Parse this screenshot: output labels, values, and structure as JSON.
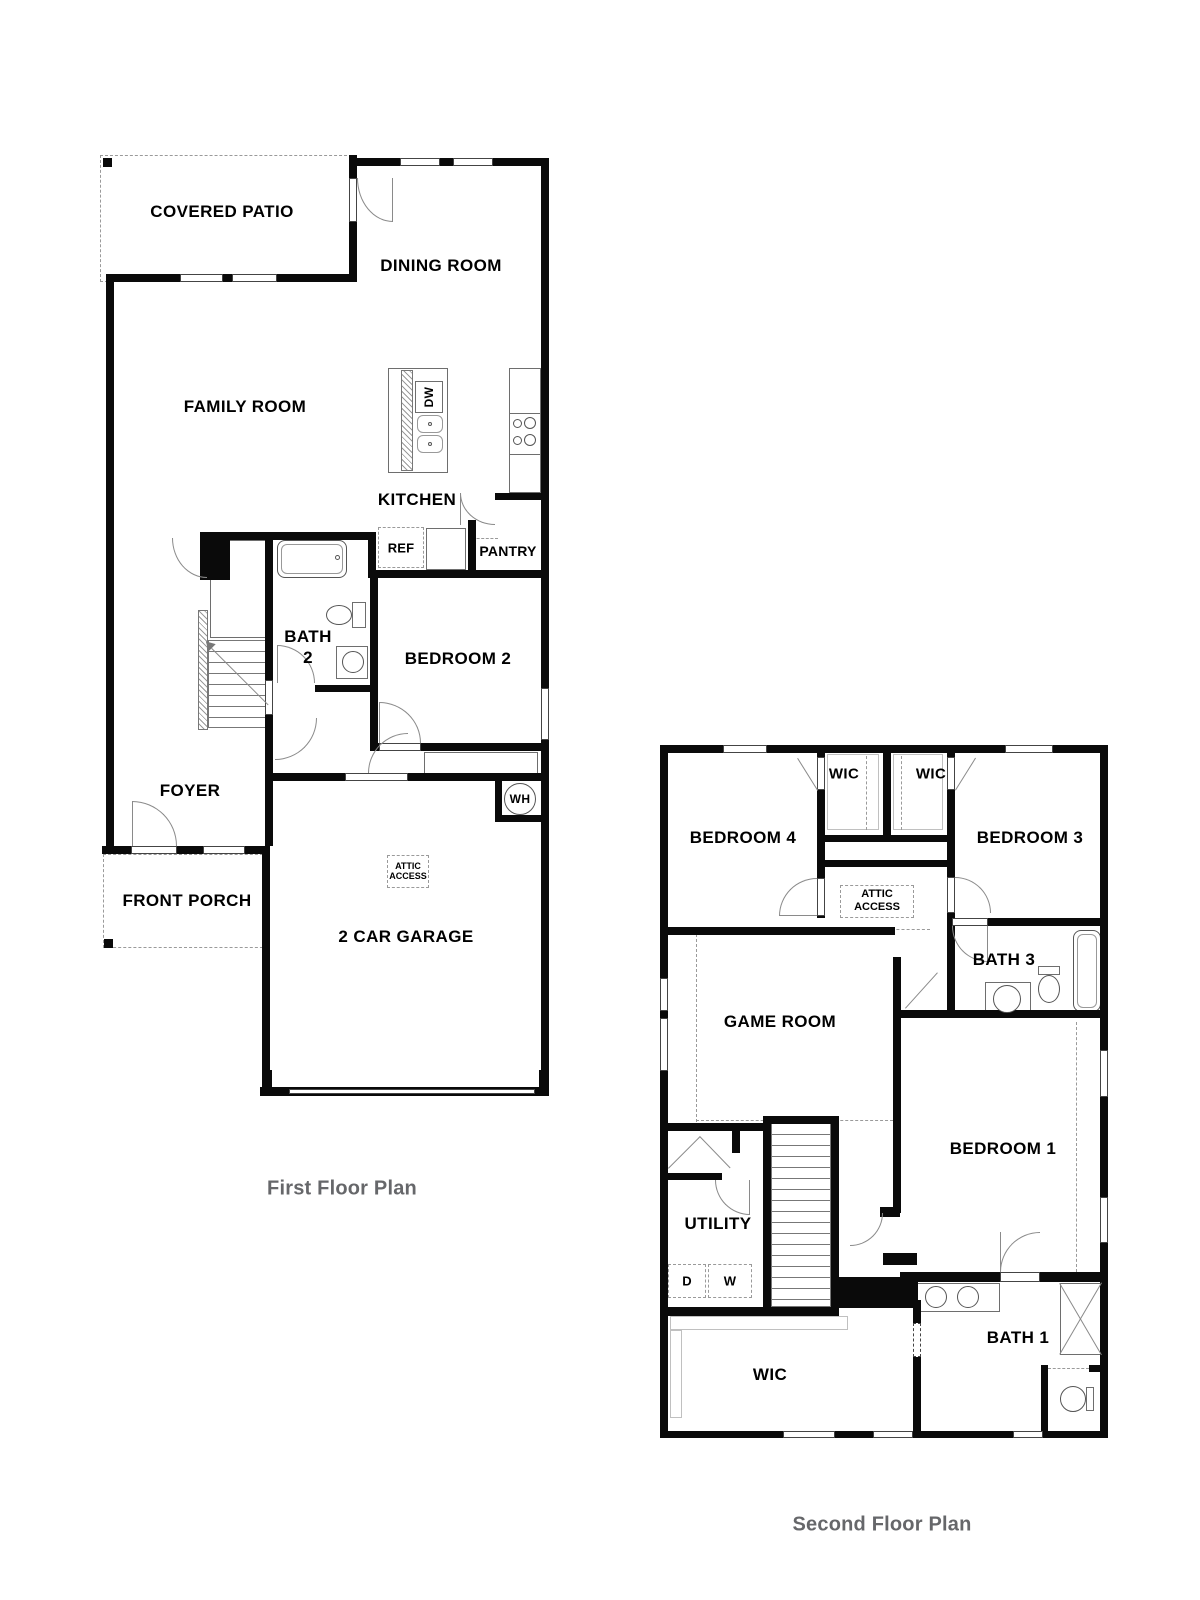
{
  "first_floor": {
    "title": "First Floor Plan",
    "rooms": {
      "covered_patio": "COVERED PATIO",
      "dining_room": "DINING ROOM",
      "family_room": "FAMILY ROOM",
      "kitchen": "KITCHEN",
      "pantry": "PANTRY",
      "bath_2_line1": "BATH",
      "bath_2_line2": "2",
      "bedroom_2": "BEDROOM 2",
      "foyer": "FOYER",
      "front_porch": "FRONT PORCH",
      "garage": "2 CAR GARAGE"
    },
    "fixtures": {
      "dishwasher": "DW",
      "refrigerator": "REF",
      "water_heater": "WH",
      "attic_access_line1": "ATTIC",
      "attic_access_line2": "ACCESS"
    }
  },
  "second_floor": {
    "title": "Second Floor Plan",
    "rooms": {
      "bedroom_4": "BEDROOM 4",
      "wic_left": "WIC",
      "wic_right": "WIC",
      "bedroom_3": "BEDROOM 3",
      "bath_3": "BATH 3",
      "game_room": "GAME ROOM",
      "bedroom_1": "BEDROOM 1",
      "utility": "UTILITY",
      "bath_1": "BATH 1",
      "wic_main": "WIC"
    },
    "fixtures": {
      "attic_access_line1": "ATTIC",
      "attic_access_line2": "ACCESS",
      "dryer": "D",
      "washer": "W"
    }
  },
  "colors": {
    "wall": "#0a0a0a",
    "label": "#000000",
    "title": "#66676a"
  }
}
